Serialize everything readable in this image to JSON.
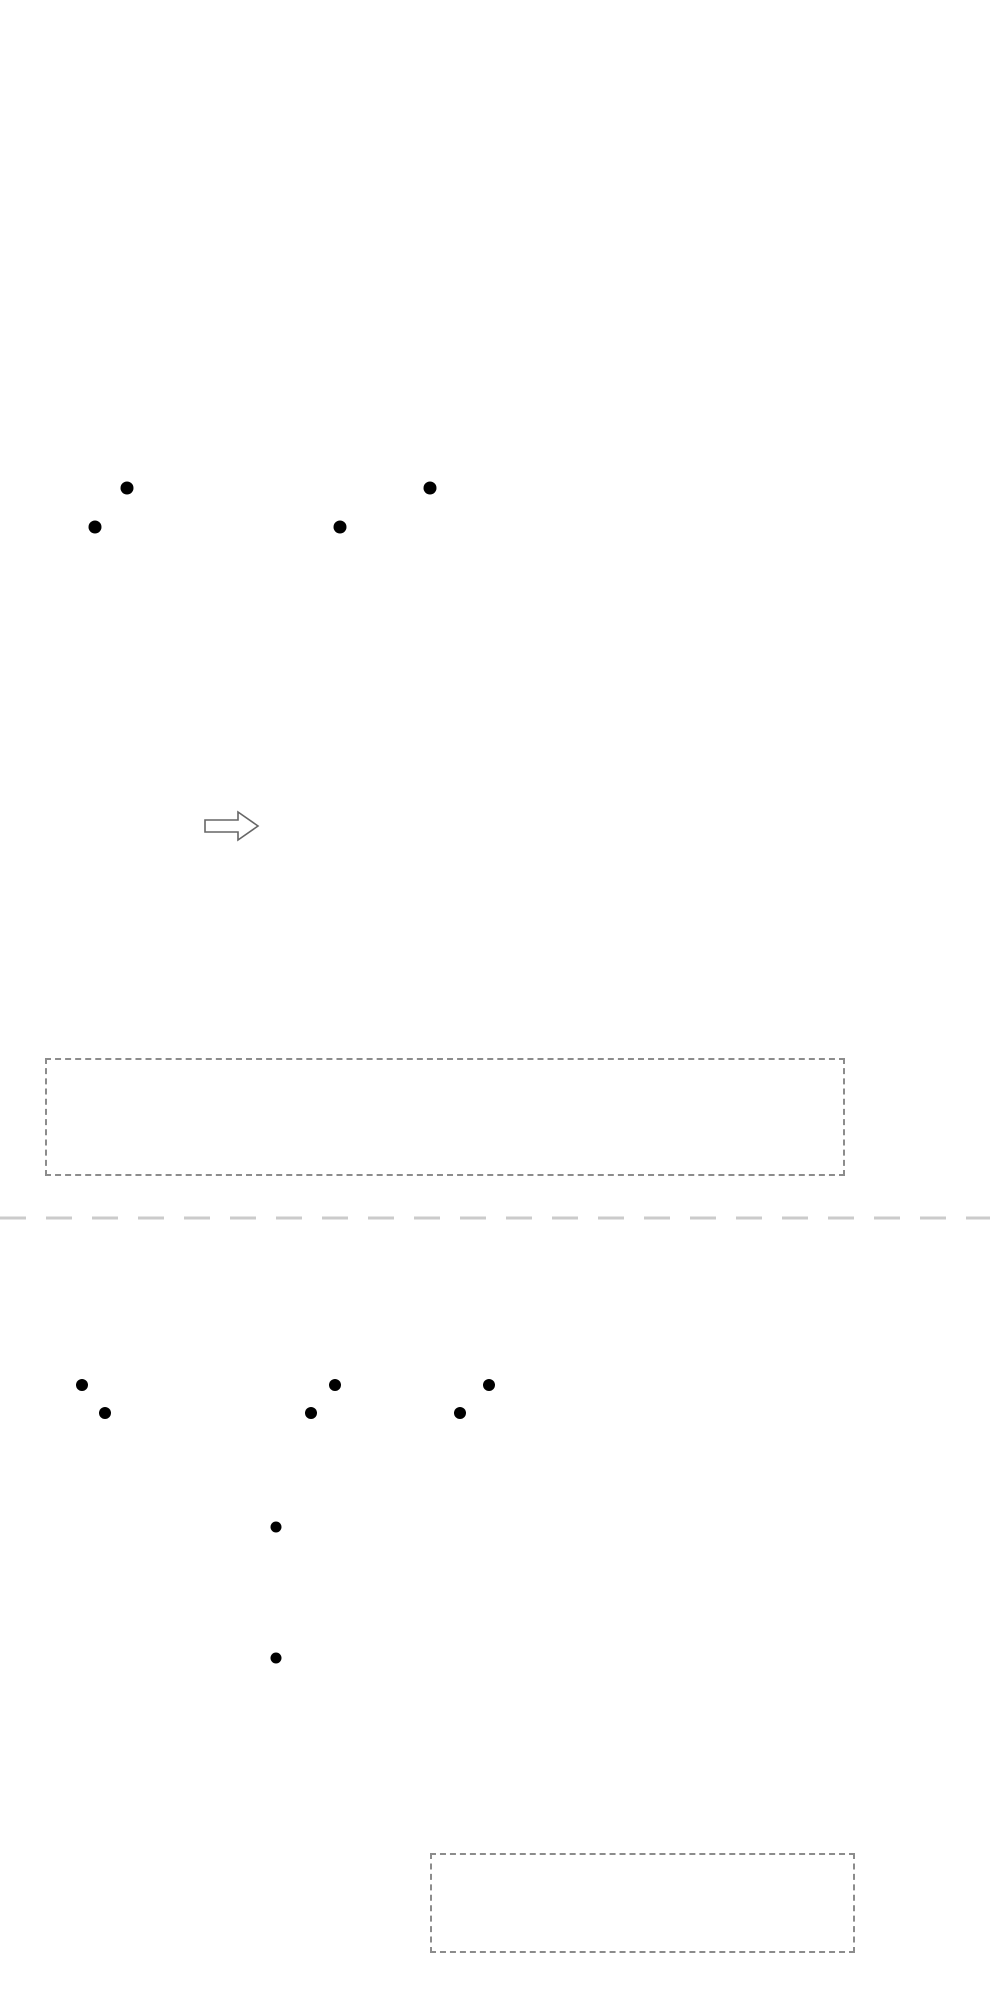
{
  "colors": {
    "red": "#e60012",
    "black_line": "#231815",
    "magenta": "#ec008c",
    "blue": "#29abe2",
    "green": "#009944",
    "underline": "#8b1c1c",
    "legend_gray": "#8c8c8c"
  },
  "header": {
    "title": "仪表接线"
  },
  "sections": [
    {
      "title": "二线制压力变送器输入控制电路",
      "note": "此电路为简易示意图，不含电气保护，具体布线请在专业电工指导下进行；",
      "power": {
        "label": "电源端",
        "live": "L",
        "neutral": "N"
      },
      "solenoid": {
        "label": "电磁阀",
        "motor": "M"
      },
      "feed_labels": [
        "+",
        "DC24V",
        "−",
        "+",
        "DC24V",
        "−"
      ],
      "left_terminals": [
        "1",
        "2",
        "3",
        "4",
        "5",
        "6",
        "7",
        "8",
        "9",
        "10",
        "11",
        "12"
      ],
      "dual_terminals": [
        [
          "25",
          "13"
        ],
        [
          "26",
          "14"
        ],
        [
          "27",
          "15"
        ],
        [
          "28",
          "16"
        ],
        [
          "29",
          "17"
        ],
        [
          "30",
          "18"
        ],
        [
          "31",
          "19"
        ],
        [
          "32",
          "20"
        ],
        [
          "33",
          "21"
        ],
        [
          "34",
          "22"
        ],
        [
          "35",
          "23"
        ],
        [
          "36",
          "24"
        ]
      ],
      "right_labels": [
        {
          "row": 2,
          "text": "mAin+"
        },
        {
          "row": 6,
          "text": "mAin−"
        },
        {
          "row": 8,
          "text": "mAin+"
        },
        {
          "row": 12,
          "text": "mAin−"
        }
      ],
      "transmitters": [
        {
          "label": "K2 压力变送器",
          "polarity": [
            "+",
            "−",
            "+",
            "−"
          ],
          "ab": [
            "A",
            "B"
          ],
          "bracket": "A"
        },
        {
          "label": "K2 压力变送器",
          "polarity": [
            "+",
            "−",
            "+",
            "−"
          ],
          "ab": [
            "A",
            "B"
          ],
          "bracket": "A"
        }
      ],
      "legend": {
        "groups": [
          {
            "type": "pair",
            "title": "PV输入",
            "rows": [
              [
                "20",
                "+"
              ],
              [
                "24",
                "−"
              ]
            ],
            "side": "mAin"
          },
          {
            "type": "pair",
            "title": "SV输入",
            "rows": [
              [
                "15",
                "+"
              ],
              [
                "19",
                "−"
              ]
            ],
            "side": "mAin"
          },
          {
            "type": "pair",
            "title": "馈电输出",
            "rows": [
              [
                "7",
                "+"
              ],
              [
                "8",
                "−"
              ]
            ],
            "side": "DC24V"
          },
          {
            "type": "pair",
            "title": "馈电输出",
            "rows": [
              [
                "9",
                "+"
              ],
              [
                "10",
                "−"
              ]
            ],
            "side": "DC24V"
          },
          {
            "type": "alarm",
            "title": "报警输出",
            "rows": [
              "1",
              "2",
              "3"
            ],
            "no": "NO",
            "nc": "NC",
            "name": "AL1"
          },
          {
            "type": "alarm",
            "title": "报警输出",
            "rows": [
              "4",
              "5",
              "6"
            ],
            "no": "NO",
            "nc": "NC",
            "name": "AL2"
          },
          {
            "type": "power",
            "title": "工作电源",
            "rows": [
              [
                "11",
                "L"
              ],
              [
                "12",
                "N"
              ]
            ]
          }
        ]
      }
    },
    {
      "title": "热电偶输入控制电路",
      "note": "此电路为简易示意图，不含电气保护，具体布线请在专业电工指导下进行；",
      "power": {
        "label": "电源端",
        "live": "L",
        "neutral": "N"
      },
      "relay": {
        "model": "ZX-22F(D)/2Z",
        "name": "中间继电器",
        "voltage": "AC220V",
        "top_labels": [
          "4",
          "1"
        ],
        "mid_labels": [
          "8",
          "5"
        ],
        "bottom_top_labels": [
          "12",
          "9"
        ],
        "bottom_labels": [
          "A1",
          "14",
          "A2",
          "13"
        ]
      },
      "heater": {
        "label": "电加热"
      },
      "left_terminals": [
        "1",
        "2",
        "3",
        "4",
        "5",
        "6",
        "7",
        "8",
        "9",
        "10",
        "11",
        "12"
      ],
      "dual_terminals": [
        [
          "25",
          "13"
        ],
        [
          "26",
          "14"
        ],
        [
          "27",
          "15"
        ],
        [
          "28",
          "16"
        ],
        [
          "29",
          "17"
        ],
        [
          "30",
          "18"
        ],
        [
          "31",
          "19"
        ],
        [
          "32",
          "20"
        ],
        [
          "33",
          "21"
        ],
        [
          "34",
          "22"
        ],
        [
          "35",
          "23"
        ],
        [
          "36",
          "24"
        ]
      ],
      "right_labels": [
        {
          "row": 6,
          "text": "A+"
        },
        {
          "row": 7,
          "text": "B−"
        },
        {
          "row": 11,
          "text": "A+"
        },
        {
          "row": 12,
          "text": "B−"
        }
      ],
      "thermocouples": [
        {
          "label": "热电偶"
        },
        {
          "label": "热电偶"
        }
      ],
      "legend": {
        "groups": [
          {
            "type": "pair2",
            "title": "SV输入",
            "rows": [
              [
                "18",
                "+"
              ],
              [
                "19",
                "−"
              ]
            ],
            "side": "TC/mV"
          },
          {
            "type": "pair2",
            "title": "PV输入",
            "rows": [
              [
                "23",
                "+"
              ],
              [
                "24",
                "−"
              ]
            ],
            "side": "TC/mV"
          },
          {
            "type": "alarm",
            "title": "报警输出",
            "rows": [
              "1",
              "2",
              "3"
            ],
            "no": "NO",
            "nc": "NC",
            "name": "AL1"
          },
          {
            "type": "power",
            "title": "工作电源",
            "rows": [
              [
                "11",
                "L"
              ],
              [
                "12",
                "N"
              ]
            ]
          }
        ]
      }
    }
  ]
}
